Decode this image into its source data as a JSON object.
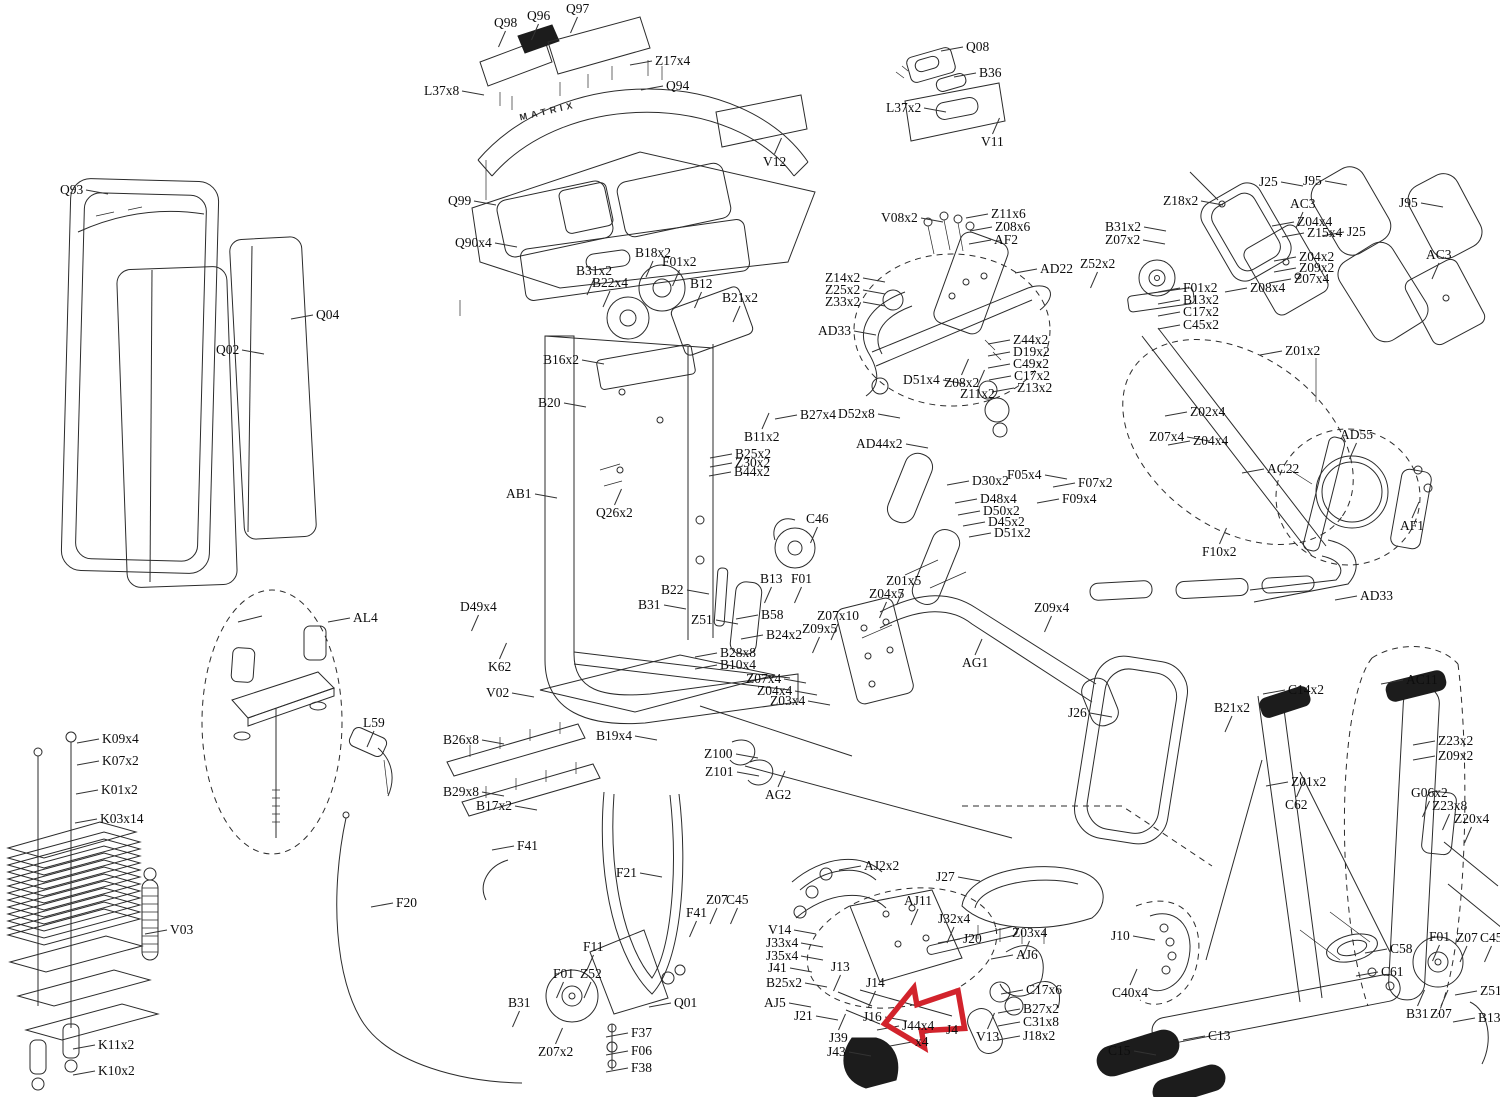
{
  "doc": {
    "brand": "MATRIX",
    "type": "exploded-parts-diagram"
  },
  "colors": {
    "line": "#2b2b2b",
    "accent_red": "#d2232c",
    "background": "#ffffff",
    "leader": "#333333"
  },
  "red_arrow": {
    "x": 884,
    "y": 984,
    "width": 78,
    "height": 66,
    "rotation": -10
  },
  "labels": [
    {
      "t": "Q98",
      "x": 494,
      "y": 16,
      "s": "b"
    },
    {
      "t": "Q96",
      "x": 527,
      "y": 9,
      "s": "b"
    },
    {
      "t": "Q97",
      "x": 566,
      "y": 2,
      "s": "b"
    },
    {
      "t": "Z17x4",
      "x": 655,
      "y": 54,
      "s": "l"
    },
    {
      "t": "L37x8",
      "x": 424,
      "y": 84,
      "s": "r"
    },
    {
      "t": "Q94",
      "x": 666,
      "y": 79,
      "s": "l"
    },
    {
      "t": "Q99",
      "x": 448,
      "y": 194,
      "s": "r"
    },
    {
      "t": "Q90x4",
      "x": 455,
      "y": 236,
      "s": "r"
    },
    {
      "t": "Q08",
      "x": 966,
      "y": 40,
      "s": "l"
    },
    {
      "t": "B36",
      "x": 979,
      "y": 66,
      "s": "l"
    },
    {
      "t": "L37x2",
      "x": 886,
      "y": 101,
      "s": "r"
    },
    {
      "t": "V11",
      "x": 981,
      "y": 135,
      "s": "t"
    },
    {
      "t": "V12",
      "x": 763,
      "y": 155,
      "s": "t"
    },
    {
      "t": "V08x2",
      "x": 881,
      "y": 211,
      "s": "r"
    },
    {
      "t": "Z11x6",
      "x": 991,
      "y": 207,
      "s": "l"
    },
    {
      "t": "Z08x6",
      "x": 995,
      "y": 220,
      "s": "l"
    },
    {
      "t": "AF2",
      "x": 994,
      "y": 233,
      "s": "l"
    },
    {
      "t": "AD22",
      "x": 1040,
      "y": 262,
      "s": "l"
    },
    {
      "t": "B31x2",
      "x": 1105,
      "y": 220,
      "s": "r"
    },
    {
      "t": "Z07x2",
      "x": 1105,
      "y": 233,
      "s": "r"
    },
    {
      "t": "Z52x2",
      "x": 1080,
      "y": 257,
      "s": "b"
    },
    {
      "t": "Z18x2",
      "x": 1163,
      "y": 194,
      "s": "r"
    },
    {
      "t": "J25",
      "x": 1259,
      "y": 175,
      "s": "r"
    },
    {
      "t": "J95",
      "x": 1303,
      "y": 174,
      "s": "r"
    },
    {
      "t": "AC3",
      "x": 1290,
      "y": 197,
      "s": "b"
    },
    {
      "t": "Z04x4",
      "x": 1297,
      "y": 215,
      "s": "l"
    },
    {
      "t": "Z15x4",
      "x": 1307,
      "y": 226,
      "s": "l"
    },
    {
      "t": "Z04x2",
      "x": 1299,
      "y": 250,
      "s": "l"
    },
    {
      "t": "Z09x2",
      "x": 1299,
      "y": 261,
      "s": "l"
    },
    {
      "t": "Z07x4",
      "x": 1294,
      "y": 272,
      "s": "l"
    },
    {
      "t": "Z08x4",
      "x": 1250,
      "y": 281,
      "s": "l"
    },
    {
      "t": "J25",
      "x": 1347,
      "y": 225,
      "s": "l"
    },
    {
      "t": "J95",
      "x": 1399,
      "y": 196,
      "s": "r"
    },
    {
      "t": "AC3",
      "x": 1426,
      "y": 248,
      "s": "b"
    },
    {
      "t": "F01x2",
      "x": 1183,
      "y": 281,
      "s": "l"
    },
    {
      "t": "B13x2",
      "x": 1183,
      "y": 293,
      "s": "l"
    },
    {
      "t": "C17x2",
      "x": 1183,
      "y": 305,
      "s": "l"
    },
    {
      "t": "C45x2",
      "x": 1183,
      "y": 318,
      "s": "l"
    },
    {
      "t": "Z01x2",
      "x": 1285,
      "y": 344,
      "s": "l"
    },
    {
      "t": "Z14x2",
      "x": 825,
      "y": 271,
      "s": "r"
    },
    {
      "t": "Z25x2",
      "x": 825,
      "y": 283,
      "s": "r"
    },
    {
      "t": "Z33x2",
      "x": 825,
      "y": 295,
      "s": "r"
    },
    {
      "t": "AD33",
      "x": 818,
      "y": 324,
      "s": "r"
    },
    {
      "t": "Z44x2",
      "x": 1013,
      "y": 333,
      "s": "l"
    },
    {
      "t": "D19x2",
      "x": 1013,
      "y": 345,
      "s": "l"
    },
    {
      "t": "C49x2",
      "x": 1013,
      "y": 357,
      "s": "l"
    },
    {
      "t": "C17x2",
      "x": 1014,
      "y": 369,
      "s": "l"
    },
    {
      "t": "Z13x2",
      "x": 1017,
      "y": 381,
      "s": "l"
    },
    {
      "t": "D51x4",
      "x": 903,
      "y": 373,
      "s": "r"
    },
    {
      "t": "Z08x2",
      "x": 944,
      "y": 376,
      "s": "t"
    },
    {
      "t": "Z11x2",
      "x": 960,
      "y": 387,
      "s": "t"
    },
    {
      "t": "D52x8",
      "x": 838,
      "y": 407,
      "s": "r"
    },
    {
      "t": "AD44x2",
      "x": 856,
      "y": 437,
      "s": "r"
    },
    {
      "t": "D30x2",
      "x": 972,
      "y": 474,
      "s": "l"
    },
    {
      "t": "D48x4",
      "x": 980,
      "y": 492,
      "s": "l"
    },
    {
      "t": "D50x2",
      "x": 983,
      "y": 504,
      "s": "l"
    },
    {
      "t": "D45x2",
      "x": 988,
      "y": 515,
      "s": "l"
    },
    {
      "t": "D51x2",
      "x": 994,
      "y": 526,
      "s": "l"
    },
    {
      "t": "F05x4",
      "x": 1007,
      "y": 468,
      "s": "r"
    },
    {
      "t": "F07x2",
      "x": 1078,
      "y": 476,
      "s": "l"
    },
    {
      "t": "F09x4",
      "x": 1062,
      "y": 492,
      "s": "l"
    },
    {
      "t": "Z02x4",
      "x": 1190,
      "y": 405,
      "s": "l"
    },
    {
      "t": "Z07x4",
      "x": 1149,
      "y": 430,
      "s": "r"
    },
    {
      "t": "Z04x4",
      "x": 1193,
      "y": 434,
      "s": "l"
    },
    {
      "t": "AC22",
      "x": 1267,
      "y": 462,
      "s": "l"
    },
    {
      "t": "AD55",
      "x": 1340,
      "y": 428,
      "s": "b"
    },
    {
      "t": "AF1",
      "x": 1400,
      "y": 519,
      "s": "t"
    },
    {
      "t": "F10x2",
      "x": 1202,
      "y": 545,
      "s": "t"
    },
    {
      "t": "AD33",
      "x": 1360,
      "y": 589,
      "s": "l"
    },
    {
      "t": "B18x2",
      "x": 635,
      "y": 246,
      "s": "b"
    },
    {
      "t": "F01x2",
      "x": 662,
      "y": 255,
      "s": "b"
    },
    {
      "t": "B31x2",
      "x": 576,
      "y": 264,
      "s": "b"
    },
    {
      "t": "B22x4",
      "x": 592,
      "y": 276,
      "s": "b"
    },
    {
      "t": "B12",
      "x": 690,
      "y": 277,
      "s": "b"
    },
    {
      "t": "B21x2",
      "x": 722,
      "y": 291,
      "s": "b"
    },
    {
      "t": "B16x2",
      "x": 543,
      "y": 353,
      "s": "r"
    },
    {
      "t": "B20",
      "x": 538,
      "y": 396,
      "s": "r"
    },
    {
      "t": "B27x4",
      "x": 800,
      "y": 408,
      "s": "l"
    },
    {
      "t": "B11x2",
      "x": 744,
      "y": 430,
      "s": "t"
    },
    {
      "t": "B25x2",
      "x": 735,
      "y": 447,
      "s": "l"
    },
    {
      "t": "Z30x2",
      "x": 735,
      "y": 456,
      "s": "l"
    },
    {
      "t": "B44x2",
      "x": 734,
      "y": 465,
      "s": "l"
    },
    {
      "t": "AB1",
      "x": 506,
      "y": 487,
      "s": "r"
    },
    {
      "t": "Q26x2",
      "x": 596,
      "y": 506,
      "s": "t"
    },
    {
      "t": "B22",
      "x": 661,
      "y": 583,
      "s": "r"
    },
    {
      "t": "B31",
      "x": 638,
      "y": 598,
      "s": "r"
    },
    {
      "t": "Z51",
      "x": 691,
      "y": 613,
      "s": "r"
    },
    {
      "t": "B13",
      "x": 760,
      "y": 572,
      "s": "b"
    },
    {
      "t": "F01",
      "x": 791,
      "y": 572,
      "s": "b"
    },
    {
      "t": "C46",
      "x": 806,
      "y": 512,
      "s": "b"
    },
    {
      "t": "B58",
      "x": 761,
      "y": 608,
      "s": "l"
    },
    {
      "t": "B24x2",
      "x": 766,
      "y": 628,
      "s": "l"
    },
    {
      "t": "B28x8",
      "x": 720,
      "y": 646,
      "s": "l"
    },
    {
      "t": "B10x4",
      "x": 720,
      "y": 658,
      "s": "l"
    },
    {
      "t": "D49x4",
      "x": 460,
      "y": 600,
      "s": "b"
    },
    {
      "t": "K62",
      "x": 488,
      "y": 660,
      "s": "t"
    },
    {
      "t": "V02",
      "x": 486,
      "y": 686,
      "s": "r"
    },
    {
      "t": "Z07x4",
      "x": 746,
      "y": 672,
      "s": "r"
    },
    {
      "t": "Z04x4",
      "x": 757,
      "y": 684,
      "s": "r"
    },
    {
      "t": "Z03x4",
      "x": 770,
      "y": 694,
      "s": "r"
    },
    {
      "t": "B26x8",
      "x": 443,
      "y": 733,
      "s": "r"
    },
    {
      "t": "B29x8",
      "x": 443,
      "y": 785,
      "s": "r"
    },
    {
      "t": "B17x2",
      "x": 476,
      "y": 799,
      "s": "r"
    },
    {
      "t": "B19x4",
      "x": 596,
      "y": 729,
      "s": "r"
    },
    {
      "t": "Z100",
      "x": 704,
      "y": 747,
      "s": "r"
    },
    {
      "t": "Z101",
      "x": 705,
      "y": 765,
      "s": "r"
    },
    {
      "t": "AG2",
      "x": 765,
      "y": 788,
      "s": "t"
    },
    {
      "t": "Z01x5",
      "x": 886,
      "y": 574,
      "s": "b"
    },
    {
      "t": "Z04x5",
      "x": 869,
      "y": 587,
      "s": "b"
    },
    {
      "t": "Z07x10",
      "x": 817,
      "y": 609,
      "s": "b"
    },
    {
      "t": "Z09x5",
      "x": 802,
      "y": 622,
      "s": "b"
    },
    {
      "t": "AG1",
      "x": 962,
      "y": 656,
      "s": "t"
    },
    {
      "t": "Z09x4",
      "x": 1034,
      "y": 601,
      "s": "b"
    },
    {
      "t": "J26",
      "x": 1068,
      "y": 706,
      "s": "r"
    },
    {
      "t": "Q93",
      "x": 60,
      "y": 183,
      "s": "r"
    },
    {
      "t": "Q02",
      "x": 216,
      "y": 343,
      "s": "r"
    },
    {
      "t": "Q04",
      "x": 316,
      "y": 308,
      "s": "l"
    },
    {
      "t": "AL4",
      "x": 353,
      "y": 611,
      "s": "l"
    },
    {
      "t": "L59",
      "x": 363,
      "y": 716,
      "s": "b"
    },
    {
      "t": "K09x4",
      "x": 102,
      "y": 732,
      "s": "l"
    },
    {
      "t": "K07x2",
      "x": 102,
      "y": 754,
      "s": "l"
    },
    {
      "t": "K01x2",
      "x": 101,
      "y": 783,
      "s": "l"
    },
    {
      "t": "K03x14",
      "x": 100,
      "y": 812,
      "s": "l"
    },
    {
      "t": "V03",
      "x": 170,
      "y": 923,
      "s": "l"
    },
    {
      "t": "K11x2",
      "x": 98,
      "y": 1038,
      "s": "l"
    },
    {
      "t": "K10x2",
      "x": 98,
      "y": 1064,
      "s": "l"
    },
    {
      "t": "F20",
      "x": 396,
      "y": 896,
      "s": "l"
    },
    {
      "t": "F41",
      "x": 517,
      "y": 839,
      "s": "l"
    },
    {
      "t": "F21",
      "x": 616,
      "y": 866,
      "s": "r"
    },
    {
      "t": "F41",
      "x": 686,
      "y": 906,
      "s": "b"
    },
    {
      "t": "Z07",
      "x": 706,
      "y": 893,
      "s": "b"
    },
    {
      "t": "C45",
      "x": 726,
      "y": 893,
      "s": "b"
    },
    {
      "t": "F11",
      "x": 583,
      "y": 940,
      "s": "b"
    },
    {
      "t": "F01",
      "x": 553,
      "y": 967,
      "s": "b"
    },
    {
      "t": "Z52",
      "x": 580,
      "y": 967,
      "s": "b"
    },
    {
      "t": "B31",
      "x": 508,
      "y": 996,
      "s": "b"
    },
    {
      "t": "Z07x2",
      "x": 538,
      "y": 1045,
      "s": "t"
    },
    {
      "t": "Q01",
      "x": 674,
      "y": 996,
      "s": "l"
    },
    {
      "t": "F37",
      "x": 631,
      "y": 1026,
      "s": "l"
    },
    {
      "t": "F06",
      "x": 631,
      "y": 1044,
      "s": "l"
    },
    {
      "t": "F38",
      "x": 631,
      "y": 1061,
      "s": "l"
    },
    {
      "t": "V14",
      "x": 768,
      "y": 923,
      "s": "r"
    },
    {
      "t": "J33x4",
      "x": 766,
      "y": 936,
      "s": "r"
    },
    {
      "t": "J35x4",
      "x": 766,
      "y": 949,
      "s": "r"
    },
    {
      "t": "J41",
      "x": 768,
      "y": 961,
      "s": "r"
    },
    {
      "t": "B25x2",
      "x": 766,
      "y": 976,
      "s": "r"
    },
    {
      "t": "AJ5",
      "x": 764,
      "y": 996,
      "s": "r"
    },
    {
      "t": "J21",
      "x": 794,
      "y": 1009,
      "s": "r"
    },
    {
      "t": "AJ2x2",
      "x": 864,
      "y": 859,
      "s": "l"
    },
    {
      "t": "J27",
      "x": 936,
      "y": 870,
      "s": "r"
    },
    {
      "t": "AJ11",
      "x": 904,
      "y": 894,
      "s": "b"
    },
    {
      "t": "J32x4",
      "x": 938,
      "y": 912,
      "s": "b"
    },
    {
      "t": "J20",
      "x": 963,
      "y": 932,
      "s": "l"
    },
    {
      "t": "Z03x4",
      "x": 1012,
      "y": 926,
      "s": "b"
    },
    {
      "t": "AJ6",
      "x": 1016,
      "y": 948,
      "s": "l"
    },
    {
      "t": "J13",
      "x": 831,
      "y": 960,
      "s": "b"
    },
    {
      "t": "J14",
      "x": 866,
      "y": 976,
      "s": "b"
    },
    {
      "t": "J16",
      "x": 863,
      "y": 1010,
      "s": "r"
    },
    {
      "t": "J39",
      "x": 829,
      "y": 1031,
      "s": "t"
    },
    {
      "t": "J43",
      "x": 827,
      "y": 1045,
      "s": "r"
    },
    {
      "t": "J44x4",
      "x": 902,
      "y": 1019,
      "s": "l"
    },
    {
      "t": "x4",
      "x": 915,
      "y": 1035,
      "s": "l"
    },
    {
      "t": "J4",
      "x": 946,
      "y": 1023,
      "s": "l"
    },
    {
      "t": "V13",
      "x": 976,
      "y": 1030,
      "s": "t"
    },
    {
      "t": "C17x6",
      "x": 1026,
      "y": 983,
      "s": "l"
    },
    {
      "t": "B27x2",
      "x": 1023,
      "y": 1002,
      "s": "l"
    },
    {
      "t": "C31x8",
      "x": 1023,
      "y": 1015,
      "s": "l"
    },
    {
      "t": "J18x2",
      "x": 1023,
      "y": 1029,
      "s": "l"
    },
    {
      "t": "J10",
      "x": 1111,
      "y": 929,
      "s": "r"
    },
    {
      "t": "C40x4",
      "x": 1112,
      "y": 986,
      "s": "t"
    },
    {
      "t": "C15",
      "x": 1108,
      "y": 1044,
      "s": "r"
    },
    {
      "t": "C13",
      "x": 1208,
      "y": 1029,
      "s": "l"
    },
    {
      "t": "C58",
      "x": 1390,
      "y": 942,
      "s": "l"
    },
    {
      "t": "C61",
      "x": 1381,
      "y": 965,
      "s": "l"
    },
    {
      "t": "F01",
      "x": 1429,
      "y": 930,
      "s": "b"
    },
    {
      "t": "Z07",
      "x": 1456,
      "y": 931,
      "s": "b"
    },
    {
      "t": "C45",
      "x": 1480,
      "y": 931,
      "s": "b"
    },
    {
      "t": "Z51",
      "x": 1480,
      "y": 984,
      "s": "l"
    },
    {
      "t": "B31",
      "x": 1406,
      "y": 1007,
      "s": "t"
    },
    {
      "t": "Z07",
      "x": 1430,
      "y": 1007,
      "s": "t"
    },
    {
      "t": "B13",
      "x": 1478,
      "y": 1011,
      "s": "l"
    },
    {
      "t": "C14x2",
      "x": 1288,
      "y": 683,
      "s": "l"
    },
    {
      "t": "B21x2",
      "x": 1214,
      "y": 701,
      "s": "b"
    },
    {
      "t": "Z01x2",
      "x": 1291,
      "y": 775,
      "s": "l"
    },
    {
      "t": "C62",
      "x": 1285,
      "y": 798,
      "s": "t"
    },
    {
      "t": "AC11",
      "x": 1406,
      "y": 673,
      "s": "l"
    },
    {
      "t": "Z23x2",
      "x": 1438,
      "y": 734,
      "s": "l"
    },
    {
      "t": "Z09x2",
      "x": 1438,
      "y": 749,
      "s": "l"
    },
    {
      "t": "G06x2",
      "x": 1411,
      "y": 786,
      "s": "b"
    },
    {
      "t": "Z23x8",
      "x": 1432,
      "y": 799,
      "s": "b"
    },
    {
      "t": "Z20x4",
      "x": 1454,
      "y": 812,
      "s": "b"
    }
  ]
}
